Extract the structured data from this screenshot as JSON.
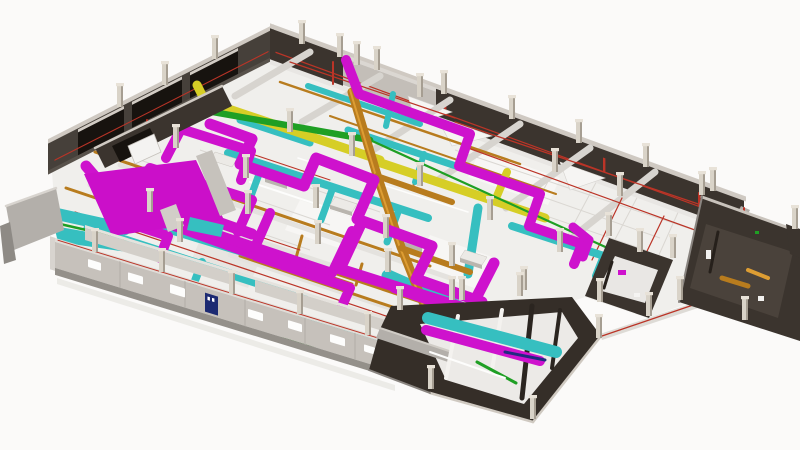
{
  "scene": {
    "kind": "3d-bim-floorplan-render",
    "description": "Isometric rendering of a single building storey with dark perimeter walls, light street-side wall and exposed colour-coded MEP services",
    "view": "axonometric-from-south-west"
  },
  "colors": {
    "bg": "#fbfaf9",
    "floor": "#f0efec",
    "floor_patch_light": "#f7f6f4",
    "floor_patch_dim": "#e7e5e1",
    "grid_line": "#dad7d2",
    "wall_dark": "#3b342e",
    "wall_dark_wing": "#352e28",
    "wall_dark_inner": "#17130f",
    "wall_cap_light": "#cfc9c2",
    "wall_concrete": "#c3beb8",
    "wall_front": "#c6c1bb",
    "wall_front_cap": "#e0ddd8",
    "wall_front_shadow": "#94908a",
    "wall_gray_mid": "#b3afaa",
    "duct_magenta": "#ce12cd",
    "floor_magenta": "#cb0fc9",
    "duct_cyan": "#36bfc0",
    "duct_yellow": "#d6ce26",
    "duct_green": "#1f9f24",
    "duct_green_dark": "#1b7a1e",
    "pipe_copper": "#b87c1e",
    "pipe_copper_hi": "#dd9d33",
    "pipe_red": "#bb3427",
    "door_navy": "#1c2a72",
    "column_face": "#d9d3c8",
    "column_side": "#a69e92",
    "column_cap": "#e8e2d8",
    "beam_gray": "#d7d4cf",
    "beam_light": "#e4e2de",
    "equip_top": "#eceae6",
    "equip_side": "#b9b5ae",
    "interior_dim": "#4a423b"
  },
  "systems": {
    "magenta_runs": "large-magenta-ductwork",
    "cyan_runs": "cyan-ductwork",
    "yellow_runs": "yellow-ductwork",
    "green_runs": "green-piping",
    "copper_runs": "copper-conduit-and-tray",
    "red_runs": "thin-red-piping",
    "navy_elements": "navy-doors-and-panels"
  }
}
